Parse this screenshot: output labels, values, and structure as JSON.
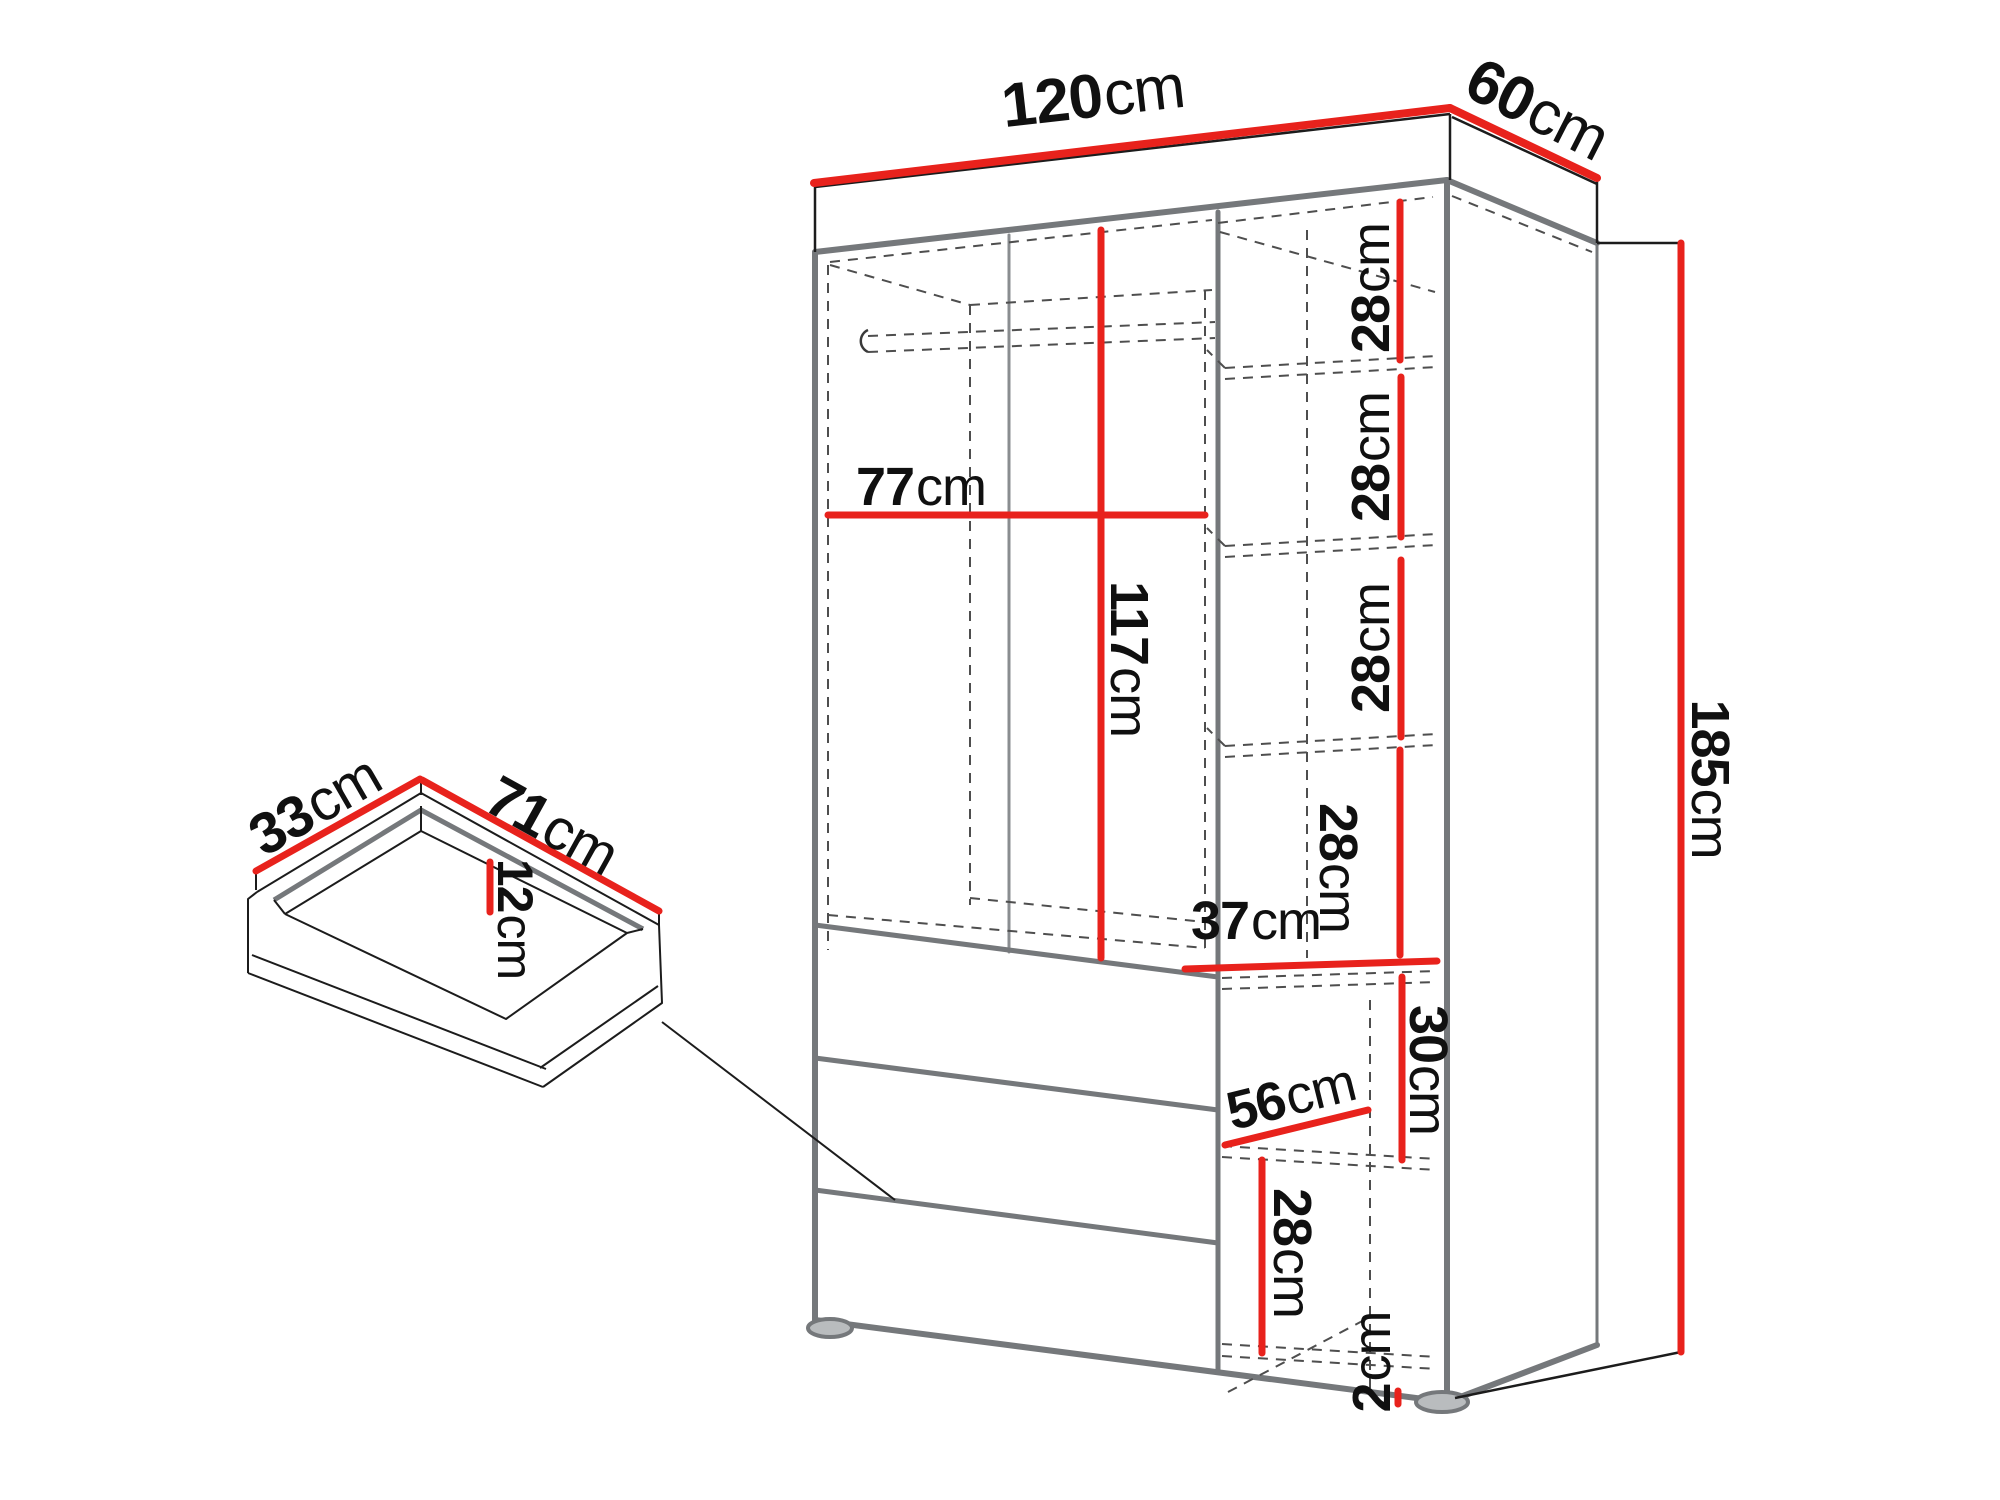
{
  "title": "Wardrobe technical dimension diagram",
  "colors": {
    "dimension_red": "#e8221c",
    "edge_gray": "#75787b",
    "outline_black": "#1c1c1c",
    "dashed_gray": "#4e4e4e",
    "background": "#ffffff",
    "text": "#101010"
  },
  "wardrobe": {
    "dims": {
      "width120": {
        "num": "120",
        "unit": "cm"
      },
      "depth60": {
        "num": "60",
        "unit": "cm"
      },
      "height185": {
        "num": "185",
        "unit": "cm"
      },
      "inner77": {
        "num": "77",
        "unit": "cm"
      },
      "inner117": {
        "num": "117",
        "unit": "cm"
      },
      "shelf28_1": {
        "num": "28",
        "unit": "cm"
      },
      "shelf28_2": {
        "num": "28",
        "unit": "cm"
      },
      "shelf28_3": {
        "num": "28",
        "unit": "cm"
      },
      "shelf28_4": {
        "num": "28",
        "unit": "cm"
      },
      "opening37": {
        "num": "37",
        "unit": "cm"
      },
      "section30": {
        "num": "30",
        "unit": "cm"
      },
      "depth56": {
        "num": "56",
        "unit": "cm"
      },
      "bottom28": {
        "num": "28",
        "unit": "cm"
      },
      "foot2": {
        "num": "2",
        "unit": "cm"
      }
    }
  },
  "drawer": {
    "dims": {
      "depth33": {
        "num": "33",
        "unit": "cm"
      },
      "width71": {
        "num": "71",
        "unit": "cm"
      },
      "height12": {
        "num": "12",
        "unit": "cm"
      }
    }
  }
}
